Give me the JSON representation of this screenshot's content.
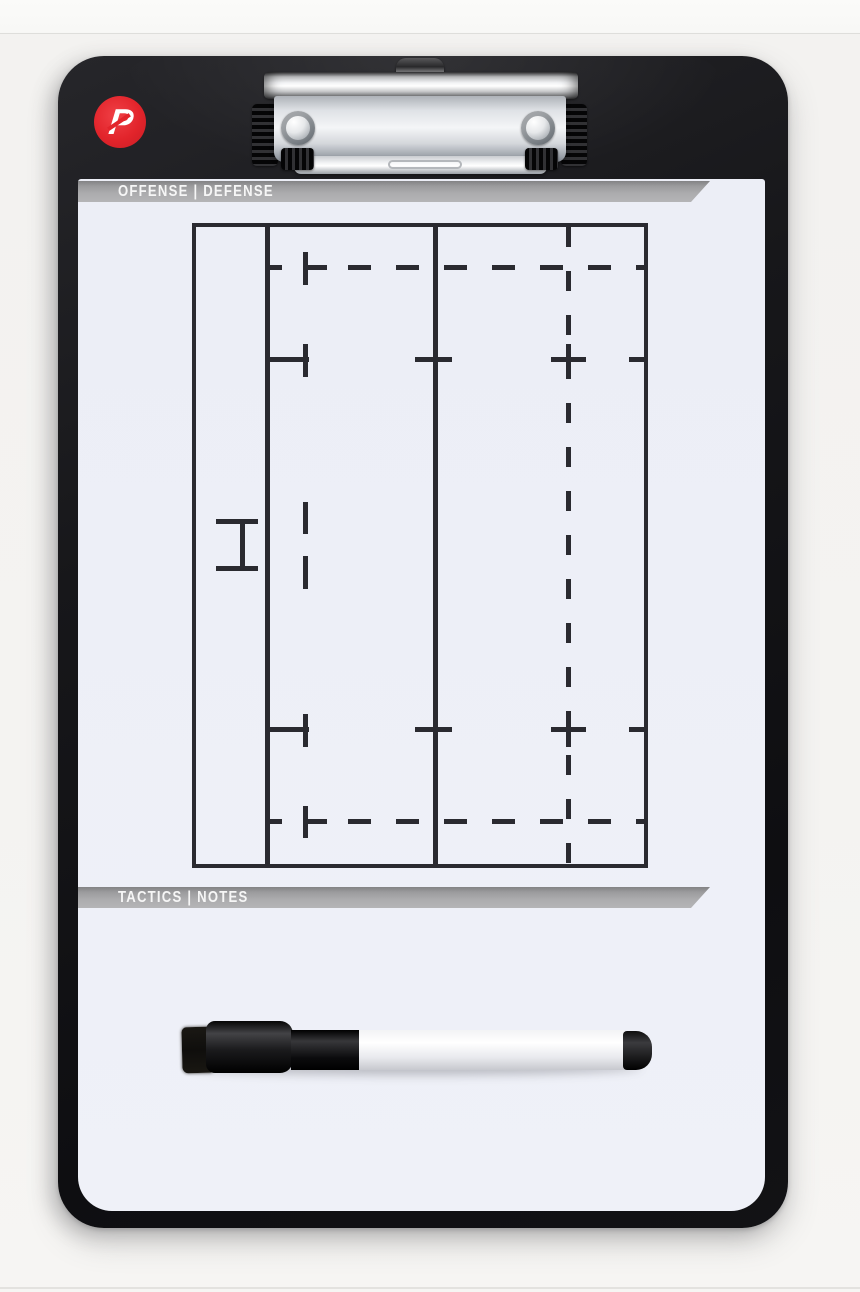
{
  "scene": {
    "type": "product-photo",
    "subject": "Coaching tactics clipboard with rugby half-field print, metal clip and dry-erase marker",
    "background_color": "#f4f3f1"
  },
  "board": {
    "frame_color": "#141417",
    "face_color": "#edeff6",
    "logo": {
      "letter": "P",
      "circle_color": "#e2242b",
      "letter_color": "#ffffff"
    },
    "top_banner": {
      "label": "OFFENSE | DEFENSE",
      "bar_color": "#a6a6a8",
      "text_color": "#f6f6f6"
    },
    "bottom_banner": {
      "label": "TACTICS | NOTES",
      "bar_color": "#a6a6a8",
      "text_color": "#f6f6f6"
    }
  },
  "field": {
    "line_color": "#2a2a30",
    "features": [
      "outer boundary (dead-ball line, touchlines, halfway line)",
      "try line (solid vertical)",
      "22 m line (solid vertical)",
      "10 m line (dashed vertical)",
      "5 m dashed lines along both touchlines",
      "15 m tick lines with crosses",
      "goal post H-mark on try line",
      "5 m dash marks beside goal posts"
    ]
  },
  "clip": {
    "finish": "polished chrome",
    "rivets": 2,
    "grip_color": "#111113",
    "hook": "hanging hook tab"
  },
  "pen": {
    "type": "dry-erase marker with eraser cap",
    "eraser_color": "#14120f",
    "cap_color": "#0c0c0e",
    "barrel_color": "#ffffff",
    "tail_color": "#0c0c0e"
  }
}
